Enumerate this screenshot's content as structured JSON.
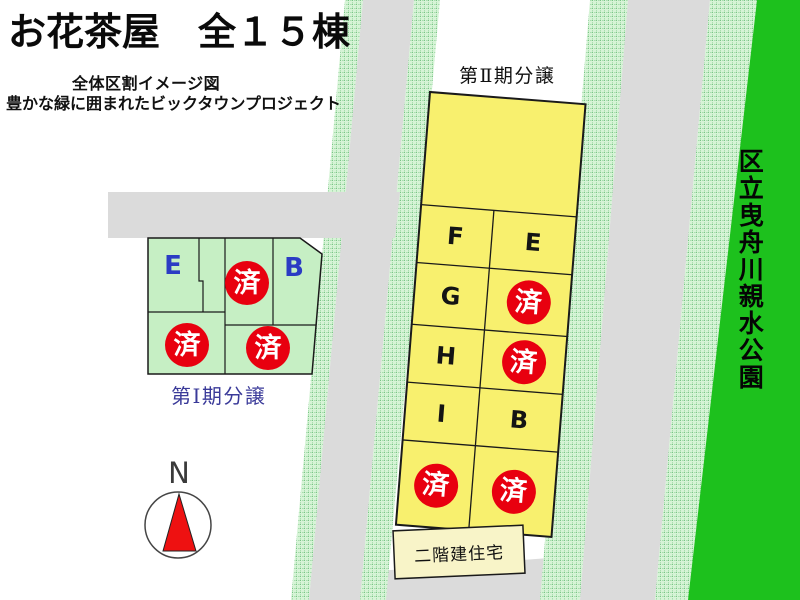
{
  "header": {
    "title": "お花茶屋　全１５棟",
    "subtitle_line1": "全体区割イメージ図",
    "subtitle_line2": "豊かな緑に囲まれたビックタウンプロジェクト"
  },
  "phase1": {
    "label": "第Ⅰ期分譲",
    "lots": [
      {
        "id": "E",
        "status": "available"
      },
      {
        "id": "",
        "status": "sold"
      },
      {
        "id": "B",
        "status": "available"
      },
      {
        "id": "",
        "status": "sold"
      },
      {
        "id": "",
        "status": "sold"
      }
    ]
  },
  "phase2": {
    "label": "第Ⅱ期分譲",
    "rows": [
      [
        {
          "id": "F",
          "status": "available"
        },
        {
          "id": "E",
          "status": "available"
        }
      ],
      [
        {
          "id": "G",
          "status": "available"
        },
        {
          "id": "",
          "status": "sold"
        }
      ],
      [
        {
          "id": "H",
          "status": "available"
        },
        {
          "id": "",
          "status": "sold"
        }
      ],
      [
        {
          "id": "I",
          "status": "available"
        },
        {
          "id": "B",
          "status": "available"
        }
      ],
      [
        {
          "id": "",
          "status": "sold"
        },
        {
          "id": "",
          "status": "sold"
        }
      ]
    ]
  },
  "sold_mark": "済",
  "park_label": "区立曳舟川親水公園",
  "building_label": "二階建住宅",
  "compass": {
    "north_label": "N"
  },
  "colors": {
    "lot_yellow": "#F8F06E",
    "lot_green": "#C6EFC4",
    "building_cream": "#F8F4C8",
    "park_green": "#1DC11D",
    "road_gray": "#DBDBDB",
    "greenbelt_hatch": "#D6F4D6",
    "sold_red": "#E8000F",
    "phase1_text_blue": "#3A3A99",
    "lot_letter_blue": "#2B3BC4"
  }
}
